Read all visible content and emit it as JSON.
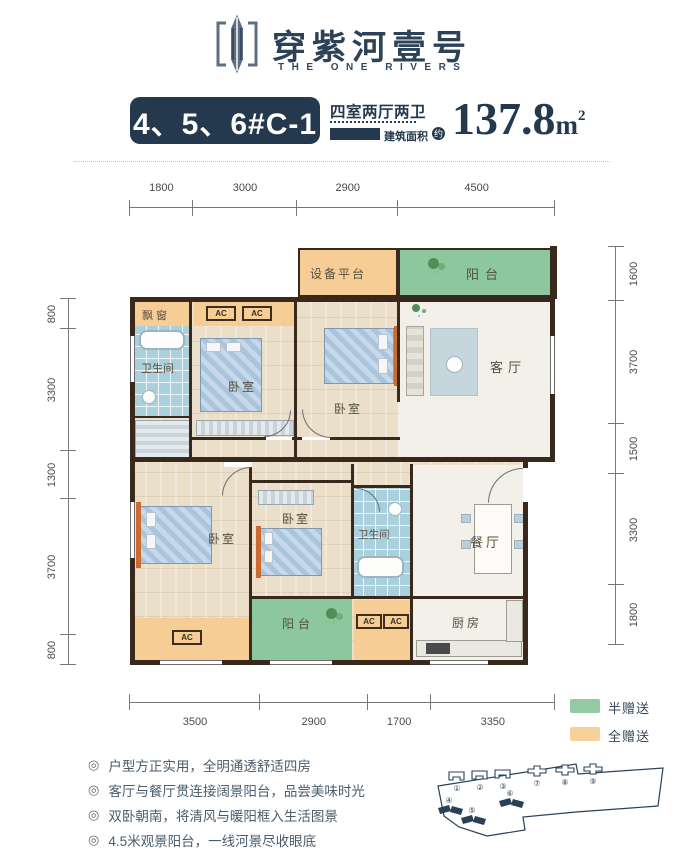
{
  "header": {
    "brand_cn": "穿紫河壹号",
    "brand_en": "THE ONE RIVERS"
  },
  "title": {
    "badge": "4、5、6#C-1",
    "layout": "四室两厅两卫",
    "area_label": "建筑面积",
    "area_approx": "约",
    "area_value": "137.8",
    "area_unit": "m",
    "area_sup": "2"
  },
  "dims": {
    "top": [
      "1800",
      "3000",
      "2900",
      "4500"
    ],
    "left": [
      "800",
      "3300",
      "1300",
      "3700",
      "800"
    ],
    "right": [
      "1600",
      "3700",
      "1500",
      "3300",
      "1800"
    ],
    "bottom": [
      "3500",
      "2900",
      "1700",
      "3350"
    ]
  },
  "rooms": {
    "equipment_platform": "设备平台",
    "balcony": "阳台",
    "bay_window": "飘窗",
    "bathroom": "卫生间",
    "bedroom": "卧室",
    "living": "客厅",
    "dining": "餐厅",
    "kitchen": "厨房",
    "ac": "AC"
  },
  "legend": {
    "items": [
      {
        "label": "半赠送",
        "color": "#93c9a3"
      },
      {
        "label": "全赠送",
        "color": "#f8d099"
      }
    ]
  },
  "features": {
    "bullet": "◎",
    "items": [
      "户型方正实用，全明通透舒适四房",
      "客厅与餐厅贯连接阔景阳台，品尝美味时光",
      "双卧朝南，将清风与暖阳框入生活图景",
      "4.5米观景阳台，一线河景尽收眼底"
    ]
  },
  "sitemap": {
    "outline_numbers": [
      "①",
      "②",
      "③",
      "⑦",
      "⑧",
      "⑨"
    ],
    "filled_numbers": [
      "④",
      "⑤",
      "⑥"
    ]
  },
  "colors": {
    "navy": "#24394e",
    "orange": "#f7cd96",
    "green": "#8cc79d",
    "blue": "#abd0dd",
    "wall": "#38291c"
  }
}
